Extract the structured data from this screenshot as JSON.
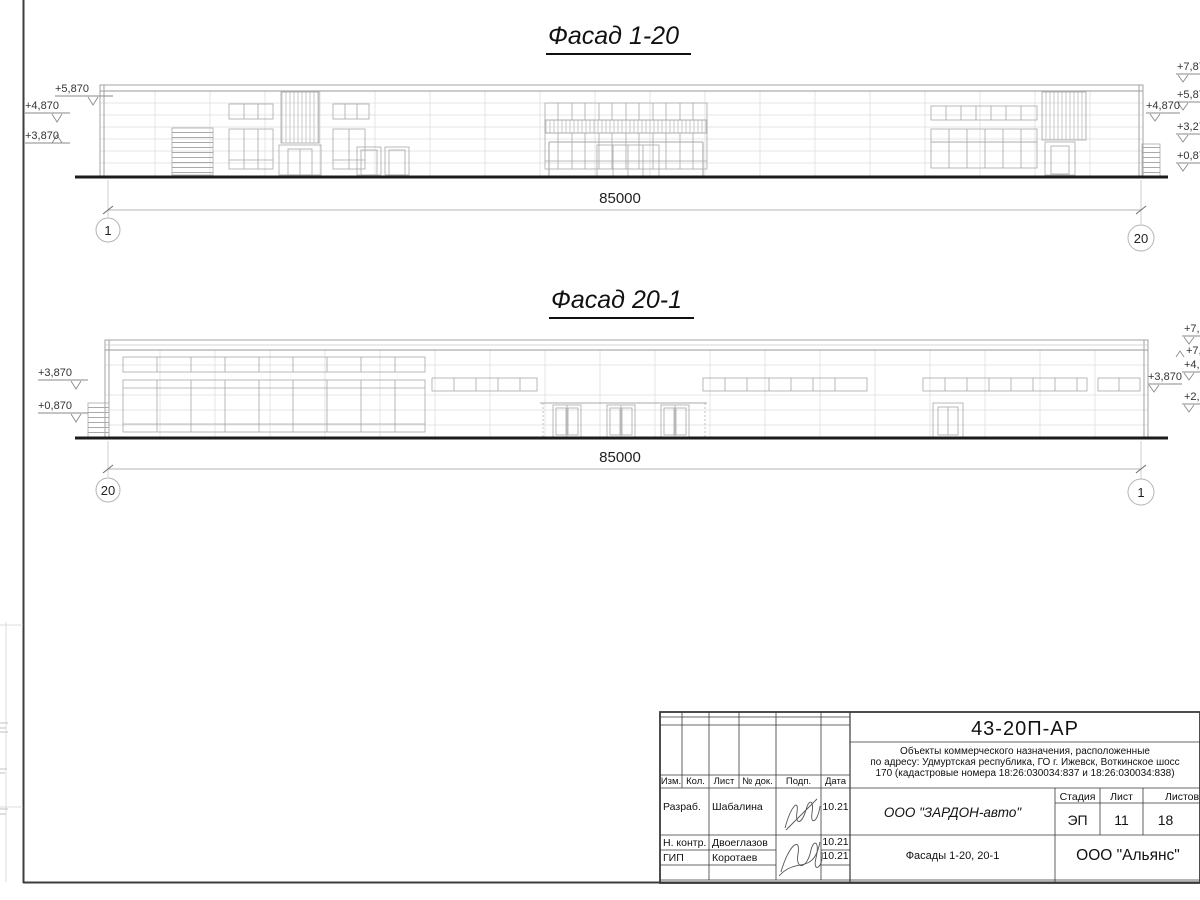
{
  "facade1": {
    "title": "Фасад 1-20",
    "dim_total": "85000",
    "axis_left": "1",
    "axis_right": "20",
    "marks_left": [
      "+5,870",
      "+4,870",
      "+3,870"
    ],
    "mark_right_inner": "+4,870",
    "marks_right_edge": [
      "+7,87",
      "+5,87",
      "+3,27",
      "+0,87"
    ]
  },
  "facade2": {
    "title": "Фасад 20-1",
    "dim_total": "85000",
    "axis_left": "20",
    "axis_right": "1",
    "marks_left": [
      "+3,870",
      "+0,870"
    ],
    "mark_right_inner": "+3,870",
    "marks_right_edge": [
      "+7,8",
      "+7,",
      "+4,8",
      "+2,1"
    ]
  },
  "titleblock": {
    "doc_code": "43-20П-АР",
    "description": [
      "Объекты коммерческого назначения, расположенные",
      "по адресу: Удмуртская республика, ГО г. Ижевск, Воткинское шосс",
      "170 (кадастровые номера 18:26:030034:837 и 18:26:030034:838)"
    ],
    "columns": [
      "Изм.",
      "Кол.",
      "Лист",
      "№ док.",
      "Подп.",
      "Дата"
    ],
    "signers": [
      {
        "role": "Разраб.",
        "name": "Шабалина",
        "date": "10.21"
      },
      {
        "role": "Н. контр.",
        "name": "Двоеглазов",
        "date": "10.21"
      },
      {
        "role": "ГИП",
        "name": "Коротаев",
        "date": "10.21"
      }
    ],
    "company": "ООО \"ЗАРДОН-авто\"",
    "stage_label": "Стадия",
    "sheet_label": "Лист",
    "sheets_label": "Листов",
    "stage": "ЭП",
    "sheet_no": "11",
    "sheets_total": "18",
    "drawing_title": "Фасады 1-20, 20-1",
    "contractor": "ООО \"Альянс\""
  }
}
